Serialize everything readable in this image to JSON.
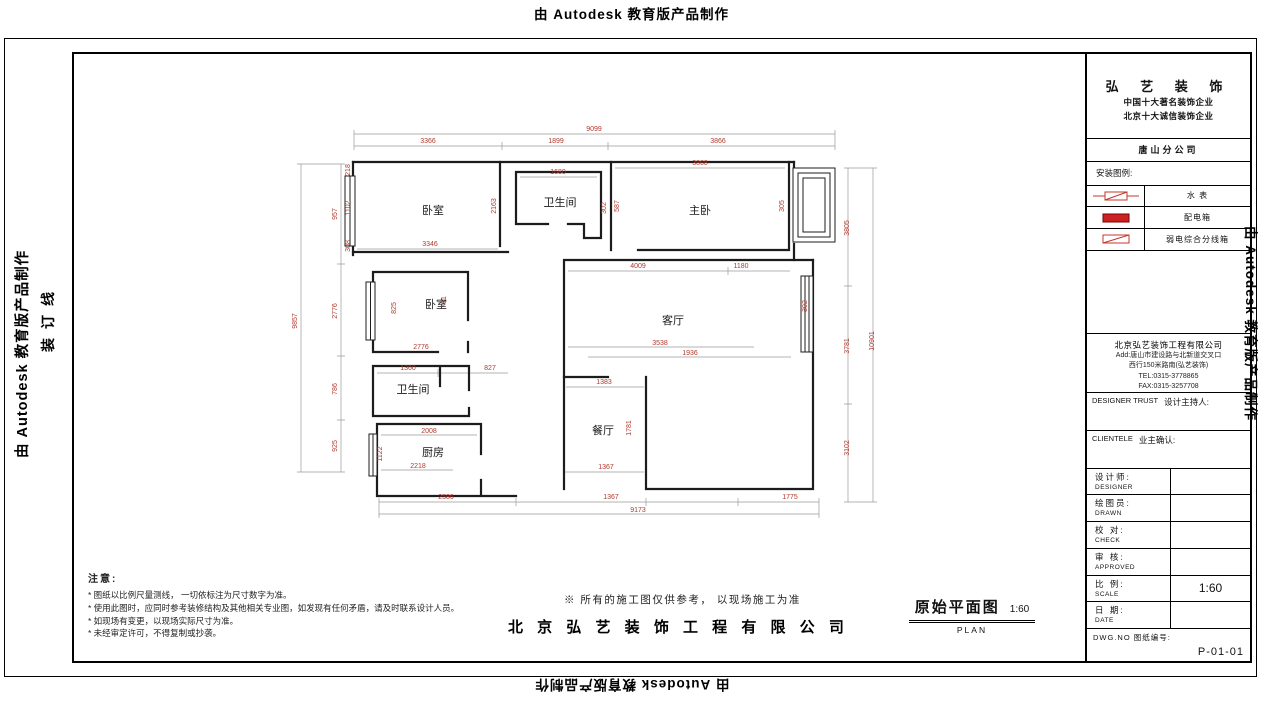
{
  "edge": {
    "autodesk": "由 Autodesk 教育版产品制作",
    "binding": "装订线"
  },
  "notes": {
    "title": "注意:",
    "items": [
      "* 图纸以比例尺量测线， 一切依标注为尺寸数字为准。",
      "* 使用此图时，应同时参考装修结构及其他相关专业图，如发现有任何矛盾，请及时联系设计人员。",
      "* 如现场有变更，以现场实际尺寸为准。",
      "* 未经审定许可，不得复制或抄袭。"
    ]
  },
  "footer": {
    "disclaimer": "※ 所有的施工图仅供参考， 以现场施工为准",
    "company_line": "北 京 弘 艺 装 饰 工 程 有 限 公 司",
    "drawing_title": "原始平面图",
    "drawing_scale": "1:60",
    "drawing_title_en": "PLAN"
  },
  "title_block": {
    "brand": "弘 艺 装 饰",
    "tagline1": "中国十大著名装饰企业",
    "tagline2": "北京十大诚信装饰企业",
    "branch": "唐山分公司",
    "legend_title": "安装图例:",
    "legend": [
      {
        "name": "water-meter",
        "label": "水  表"
      },
      {
        "name": "power-distribution-box",
        "label": "配电箱"
      },
      {
        "name": "weak-current-box",
        "label": "弱电综合分线箱"
      }
    ],
    "company": {
      "name": "北京弘艺装饰工程有限公司",
      "addr1": "Add:唐山市建设路与北新道交叉口",
      "addr2": "西行150米路南(弘艺装饰)",
      "tel": "TEL:0315-3778865",
      "fax": "FAX:0315-3257708"
    },
    "designer_host_en": "DESIGNER TRUST",
    "designer_host_cn": "设计主持人:",
    "clientele_en": "CLIENTELE",
    "clientele_cn": "业主确认:",
    "rows": [
      {
        "cn": "设计师:",
        "en": "DESIGNER",
        "value": ""
      },
      {
        "cn": "绘图员:",
        "en": "DRAWN",
        "value": ""
      },
      {
        "cn": "校 对:",
        "en": "CHECK",
        "value": ""
      },
      {
        "cn": "审 核:",
        "en": "APPROVED",
        "value": ""
      },
      {
        "cn": "比 例:",
        "en": "SCALE",
        "value": "1:60"
      },
      {
        "cn": "日 期:",
        "en": "DATE",
        "value": ""
      }
    ],
    "dwg_label": "DWG.NO  图纸编号:",
    "dwg_no": "P-01-01"
  },
  "plan": {
    "dim_color": "#b03a2e",
    "rooms": [
      {
        "label": "卧室",
        "x": 355,
        "y": 158
      },
      {
        "label": "卫生间",
        "x": 482,
        "y": 150
      },
      {
        "label": "主卧",
        "x": 622,
        "y": 158
      },
      {
        "label": "卧室",
        "x": 358,
        "y": 252
      },
      {
        "label": "客厅",
        "x": 595,
        "y": 268
      },
      {
        "label": "卫生间",
        "x": 335,
        "y": 337
      },
      {
        "label": "厨房",
        "x": 355,
        "y": 400
      },
      {
        "label": "餐厅",
        "x": 525,
        "y": 378
      }
    ],
    "dims": [
      {
        "t": "9099",
        "x": 516,
        "y": 75
      },
      {
        "t": "3366",
        "x": 350,
        "y": 87
      },
      {
        "t": "1899",
        "x": 478,
        "y": 87
      },
      {
        "t": "3866",
        "x": 640,
        "y": 87
      },
      {
        "t": "9857",
        "x": 219,
        "y": 265,
        "r": 1
      },
      {
        "t": "957",
        "x": 259,
        "y": 158,
        "r": 1
      },
      {
        "t": "2776",
        "x": 259,
        "y": 255,
        "r": 1
      },
      {
        "t": "786",
        "x": 259,
        "y": 333,
        "r": 1
      },
      {
        "t": "925",
        "x": 259,
        "y": 390,
        "r": 1
      },
      {
        "t": "218",
        "x": 272,
        "y": 114,
        "r": 1
      },
      {
        "t": "1102",
        "x": 272,
        "y": 152,
        "r": 1
      },
      {
        "t": "308",
        "x": 272,
        "y": 190,
        "r": 1
      },
      {
        "t": "2163",
        "x": 418,
        "y": 150,
        "r": 1
      },
      {
        "t": "3346",
        "x": 352,
        "y": 190
      },
      {
        "t": "1680",
        "x": 480,
        "y": 118
      },
      {
        "t": "302",
        "x": 528,
        "y": 152,
        "r": 1
      },
      {
        "t": "3868",
        "x": 622,
        "y": 109
      },
      {
        "t": "587",
        "x": 541,
        "y": 150,
        "r": 1
      },
      {
        "t": "305",
        "x": 706,
        "y": 150,
        "r": 1
      },
      {
        "t": "3805",
        "x": 771,
        "y": 172,
        "r": 1
      },
      {
        "t": "3781",
        "x": 771,
        "y": 290,
        "r": 1
      },
      {
        "t": "3102",
        "x": 771,
        "y": 392,
        "r": 1
      },
      {
        "t": "10901",
        "x": 796,
        "y": 285,
        "r": 1
      },
      {
        "t": "4009",
        "x": 560,
        "y": 212
      },
      {
        "t": "1180",
        "x": 663,
        "y": 212
      },
      {
        "t": "825",
        "x": 318,
        "y": 252,
        "r": 1
      },
      {
        "t": "781",
        "x": 368,
        "y": 246,
        "r": 1
      },
      {
        "t": "2776",
        "x": 343,
        "y": 293
      },
      {
        "t": "1360",
        "x": 330,
        "y": 314
      },
      {
        "t": "827",
        "x": 412,
        "y": 314
      },
      {
        "t": "3538",
        "x": 582,
        "y": 289
      },
      {
        "t": "1936",
        "x": 612,
        "y": 299
      },
      {
        "t": "302",
        "x": 729,
        "y": 250,
        "r": 1
      },
      {
        "t": "1383",
        "x": 526,
        "y": 328
      },
      {
        "t": "1781",
        "x": 553,
        "y": 372,
        "r": 1
      },
      {
        "t": "1367",
        "x": 528,
        "y": 413
      },
      {
        "t": "2008",
        "x": 351,
        "y": 377
      },
      {
        "t": "1122",
        "x": 304,
        "y": 398,
        "r": 1
      },
      {
        "t": "2218",
        "x": 340,
        "y": 412
      },
      {
        "t": "2586",
        "x": 368,
        "y": 443
      },
      {
        "t": "1367",
        "x": 533,
        "y": 443
      },
      {
        "t": "1775",
        "x": 712,
        "y": 443
      },
      {
        "t": "9173",
        "x": 560,
        "y": 456
      }
    ]
  }
}
